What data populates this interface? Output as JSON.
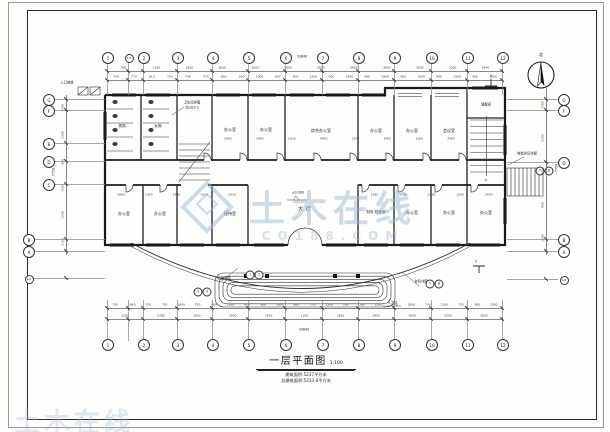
{
  "sheet": {
    "title": "一层平面图",
    "scale": "1:100",
    "note1": "建筑面积:5237平方米",
    "note2": "总建筑面积:5233.6平方米",
    "north_label": "北"
  },
  "watermark": {
    "brand": "土木在线",
    "domain": "CO188.COM",
    "partial": "土木在线",
    "color": "#9eb8d2"
  },
  "grid": {
    "cols": [
      {
        "l": "1",
        "x": 107
      },
      {
        "l": "1/1",
        "x": 128,
        "s": 1
      },
      {
        "l": "2",
        "x": 143
      },
      {
        "l": "3",
        "x": 177
      },
      {
        "l": "4",
        "x": 212
      },
      {
        "l": "5",
        "x": 248
      },
      {
        "l": "6",
        "x": 285
      },
      {
        "l": "7",
        "x": 322
      },
      {
        "l": "8",
        "x": 358
      },
      {
        "l": "9",
        "x": 394
      },
      {
        "l": "10",
        "x": 431
      },
      {
        "l": "11",
        "x": 467
      },
      {
        "l": "12",
        "x": 502
      }
    ],
    "rows_left": [
      {
        "l": "G",
        "y": 99
      },
      {
        "l": "F",
        "y": 110
      },
      {
        "l": "E",
        "y": 143
      },
      {
        "l": "D",
        "y": 161
      },
      {
        "l": "C",
        "y": 184
      },
      {
        "l": "B",
        "y": 239,
        "x": 28
      },
      {
        "l": "A",
        "y": 251,
        "x": 28
      },
      {
        "l": "1/A",
        "y": 278,
        "x": 28,
        "s": 1
      }
    ],
    "rows_right": [
      {
        "l": "G",
        "y": 99
      },
      {
        "l": "F",
        "y": 110
      },
      {
        "l": "D",
        "y": 162
      },
      {
        "l": "B",
        "y": 239
      },
      {
        "l": "A",
        "y": 251
      },
      {
        "l": "1/A",
        "y": 279,
        "s": 1
      }
    ]
  },
  "dims": {
    "rows": [
      {
        "y": 71,
        "x1": 107,
        "x2": 502,
        "v": [
          "780",
          "1320",
          "3300",
          "3600",
          "3600",
          "3600",
          "3600",
          "3600",
          "3600",
          "3600",
          "3300",
          "5400"
        ]
      },
      {
        "y": 80,
        "x1": 107,
        "x2": 502,
        "v": [
          "750",
          "770",
          "815",
          "750",
          "740",
          "775",
          "850",
          "900",
          "1800",
          "900",
          "600",
          "1500",
          "900",
          "1500",
          "900",
          "1800",
          "900",
          "1500",
          "900",
          "1500",
          "900",
          "1800"
        ]
      },
      {
        "y": 142,
        "x1": 212,
        "x2": 467,
        "noline": 1,
        "v": [
          "2400",
          "3480",
          "1500",
          "3400",
          "1500",
          "3400",
          "1500",
          "2400"
        ]
      },
      {
        "y": 198,
        "x1": 107,
        "x2": 246,
        "noline": 1,
        "v": [
          "1860",
          "1000",
          "2280",
          "1500",
          "2330"
        ]
      },
      {
        "y": 198,
        "x1": 360,
        "x2": 503,
        "noline": 1,
        "v": [
          "2280",
          "1500",
          "2330",
          "1500",
          "2400"
        ]
      },
      {
        "y": 308,
        "x1": 107,
        "x2": 502,
        "v": [
          "750",
          "1860",
          "750",
          "750",
          "1800",
          "750",
          "960",
          "1560",
          "900",
          "900",
          "1800",
          "900",
          "770",
          "1300",
          "780",
          "785",
          "1500",
          "900",
          "1800",
          "700",
          "1200",
          "750",
          "900",
          "1500"
        ]
      },
      {
        "y": 319,
        "x1": 107,
        "x2": 502,
        "v": [
          "2290",
          "2390",
          "3930",
          "3900",
          "2400",
          "1200",
          "1890",
          "3900",
          "3600",
          "2280",
          "3000"
        ]
      }
    ],
    "cols": [
      {
        "x": 66,
        "y1": 95,
        "y2": 255,
        "v": [
          "1700",
          "3300",
          "900",
          "1500",
          "1500",
          "1100"
        ]
      },
      {
        "x": 546,
        "y1": 88,
        "y2": 255,
        "v": [
          "1700",
          "3300",
          "1500",
          "900",
          "1500"
        ]
      }
    ]
  },
  "labels": {
    "rooms": [
      {
        "t": "男厕",
        "x": 122,
        "y": 127,
        "fs": 3.6
      },
      {
        "t": "女厕",
        "x": 158,
        "y": 127,
        "fs": 3.6
      },
      {
        "t": "办公室",
        "x": 230,
        "y": 130,
        "fs": 4
      },
      {
        "t": "办公室",
        "x": 266,
        "y": 130,
        "fs": 4
      },
      {
        "t": "综合办公室",
        "x": 321,
        "y": 131,
        "fs": 4
      },
      {
        "t": "办公室",
        "x": 376,
        "y": 131,
        "fs": 4
      },
      {
        "t": "办公室",
        "x": 412,
        "y": 131,
        "fs": 4
      },
      {
        "t": "会议室",
        "x": 449,
        "y": 131,
        "fs": 4
      },
      {
        "t": "储藏间",
        "x": 486,
        "y": 105,
        "fs": 3.4
      },
      {
        "t": "办公室",
        "x": 124,
        "y": 214,
        "fs": 4
      },
      {
        "t": "办公室",
        "x": 160,
        "y": 214,
        "fs": 4
      },
      {
        "t": "接待室",
        "x": 230,
        "y": 214,
        "fs": 4
      },
      {
        "t": "大厅",
        "x": 306,
        "y": 210,
        "fs": 5,
        "sp": 3
      },
      {
        "t": "财务·档案室",
        "x": 376,
        "y": 213,
        "fs": 3.6
      },
      {
        "t": "办公室",
        "x": 412,
        "y": 213,
        "fs": 4
      },
      {
        "t": "办公室",
        "x": 449,
        "y": 213,
        "fs": 4
      },
      {
        "t": "办公室",
        "x": 486,
        "y": 213,
        "fs": 4
      }
    ],
    "annotations": [
      {
        "t": "入口坡道",
        "x": 67,
        "y": 83
      },
      {
        "t": "卫生间详图",
        "x": 192,
        "y": 103
      },
      {
        "t": "见02J3-1",
        "x": 192,
        "y": 108
      },
      {
        "t": "坡道详见详图",
        "x": 527,
        "y": 154
      },
      {
        "t": "雨篷详图",
        "x": 224,
        "y": 279
      },
      {
        "t": "台阶详图",
        "x": 421,
        "y": 282
      }
    ],
    "elevations": [
      {
        "t": "±0.000",
        "x": 298,
        "y": 193
      },
      {
        "t": "-0.750",
        "x": 392,
        "y": 303
      }
    ],
    "marks": [
      {
        "t": "33840",
        "x": 302,
        "y": 57
      },
      {
        "t": "33840",
        "x": 304,
        "y": 330
      },
      {
        "t": "7750",
        "x": 54,
        "y": 172,
        "rot": -90
      },
      {
        "t": "7750",
        "x": 557,
        "y": 168,
        "rot": -90
      },
      {
        "t": "2",
        "x": 491,
        "y": 76
      },
      {
        "t": "2",
        "x": 476,
        "y": 262
      },
      {
        "t": "上",
        "x": 486,
        "y": 180,
        "fs": 3
      },
      {
        "t": "1",
        "x": 250,
        "y": 275,
        "cls": "circ"
      },
      {
        "t": "2",
        "x": 259,
        "y": 275,
        "cls": "circ"
      },
      {
        "t": "3",
        "x": 198,
        "y": 292,
        "cls": "circ"
      },
      {
        "t": "4",
        "x": 207,
        "y": 292,
        "cls": "circ"
      },
      {
        "t": "5",
        "x": 430,
        "y": 284,
        "cls": "circ"
      },
      {
        "t": "6",
        "x": 439,
        "y": 284,
        "cls": "circ"
      },
      {
        "t": "7",
        "x": 540,
        "y": 171,
        "cls": "circ"
      },
      {
        "t": "8",
        "x": 549,
        "y": 171,
        "cls": "circ"
      }
    ]
  }
}
